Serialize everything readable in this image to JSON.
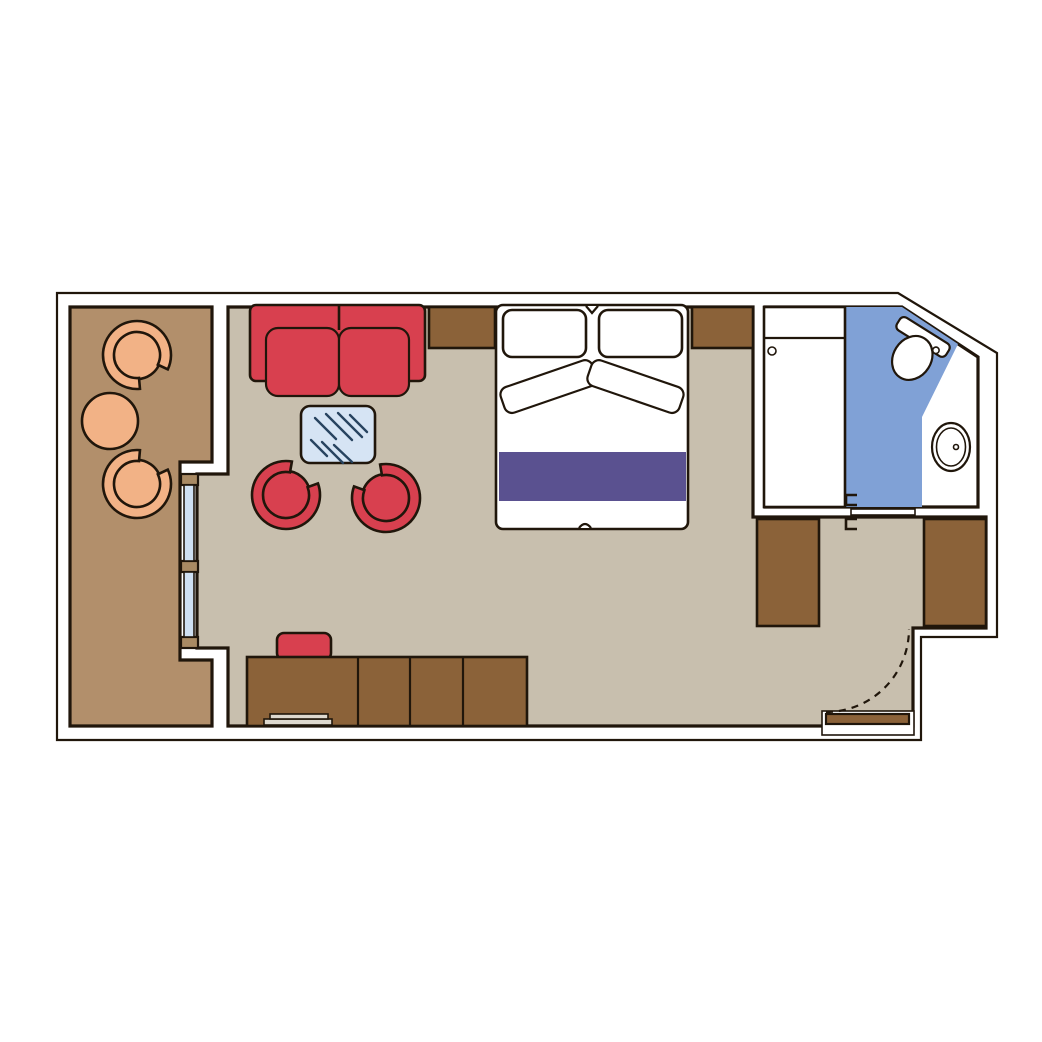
{
  "title": "Cruise cabin floor plan (top-down diagram, no text labels)",
  "colors": {
    "canvas": "#ffffff",
    "wall_fill": "#ffffff",
    "line": "#20160b",
    "balcony_floor": "#b28f6b",
    "room_floor": "#c8bfae",
    "bathroom_floor": "#80a1d6",
    "furniture_brown": "#8b6239",
    "furniture_red": "#d8404f",
    "furniture_orange": "#f2b286",
    "bed_runner_purple": "#5a5190",
    "bed_white": "#ffffff",
    "glass_table_blue": "#d6e4f4",
    "glass_table_lines": "#27435f",
    "sliding_door_glass": "#cfe0f2",
    "door_frame_tan": "#a98a63",
    "fixture_white": "#ffffff",
    "tray_gray": "#ded9cf",
    "entry_door_brown": "#8b6239"
  },
  "rooms": {
    "balcony": {
      "name": "balcony"
    },
    "cabin": {
      "name": "main cabin / bedroom-lounge"
    },
    "bathroom": {
      "name": "bathroom"
    },
    "entry": {
      "name": "entry corridor with wardrobes"
    }
  },
  "furniture": [
    "balcony-armchair-top",
    "balcony-armchair-bottom",
    "balcony-round-table",
    "sliding-glass-door",
    "sofa",
    "glass-coffee-table",
    "lounge-armchair-left",
    "lounge-armchair-right",
    "nightstand-left",
    "nightstand-right",
    "double-bed",
    "pillow-left",
    "pillow-right",
    "bed-runner",
    "desk-counter",
    "desk-stool",
    "desk-tray",
    "shower-cabinet",
    "toilet",
    "washbasin",
    "bathroom-sliding-door",
    "wardrobe-left",
    "wardrobe-right",
    "entrance-door",
    "entrance-door-swing"
  ]
}
